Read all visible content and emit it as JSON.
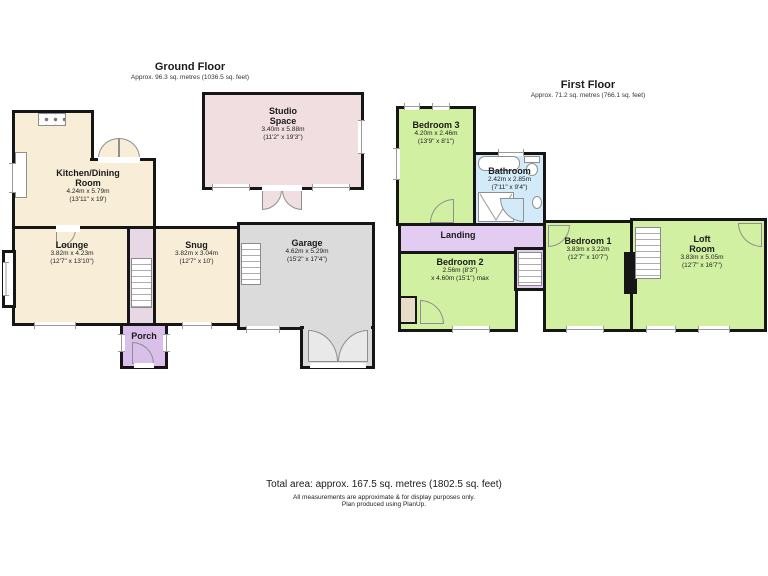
{
  "colors": {
    "wall": "#161616",
    "cream": "#f8eed8",
    "pink": "#f1dee1",
    "gray": "#dbdbdb",
    "graydoor": "#e9e9e9",
    "purple": "#d9bfe9",
    "landing": "#e2ccf1",
    "hall": "#e8d7e5",
    "green": "#d2f0a2",
    "blue": "#d3eaf8",
    "tan": "#e7dcc8"
  },
  "ground_floor": {
    "title": "Ground Floor",
    "subtitle": "Approx. 96.3 sq. metres (1036.5 sq. feet)",
    "rooms": {
      "kitchen": {
        "name": "Kitchen/Dining Room",
        "metric": "4.24m x 5.79m",
        "imperial": "(13'11\" x 19')"
      },
      "studio": {
        "name": "Studio Space",
        "metric": "3.40m x 5.88m",
        "imperial": "(11'2\" x 19'3\")"
      },
      "lounge": {
        "name": "Lounge",
        "metric": "3.82m x 4.23m",
        "imperial": "(12'7\" x 13'10\")"
      },
      "snug": {
        "name": "Snug",
        "metric": "3.82m x 3.04m",
        "imperial": "(12'7\" x 10')"
      },
      "garage": {
        "name": "Garage",
        "metric": "4.62m x 5.29m",
        "imperial": "(15'2\" x 17'4\")"
      },
      "porch": {
        "name": "Porch"
      }
    }
  },
  "first_floor": {
    "title": "First Floor",
    "subtitle": "Approx. 71.2 sq. metres (766.1 sq. feet)",
    "rooms": {
      "bedroom3": {
        "name": "Bedroom 3",
        "metric": "4.20m x 2.46m",
        "imperial": "(13'9\" x 8'1\")"
      },
      "bathroom": {
        "name": "Bathroom",
        "metric": "2.42m x 2.85m",
        "imperial": "(7'11\" x 9'4\")"
      },
      "landing": {
        "name": "Landing"
      },
      "bedroom2": {
        "name": "Bedroom 2",
        "metric": "2.56m (8'3\")",
        "imperial": "x 4.60m (15'1\") max"
      },
      "bedroom1": {
        "name": "Bedroom 1",
        "metric": "3.83m x 3.22m",
        "imperial": "(12'7\" x 10'7\")"
      },
      "loft": {
        "name": "Loft Room",
        "metric": "3.83m x 5.05m",
        "imperial": "(12'7\" x 16'7\")"
      }
    }
  },
  "footer": {
    "total": "Total area: approx. 167.5 sq. metres (1802.5 sq. feet)",
    "note1": "All measurements are approximate & for display purposes only.",
    "note2": "Plan produced using PlanUp."
  }
}
